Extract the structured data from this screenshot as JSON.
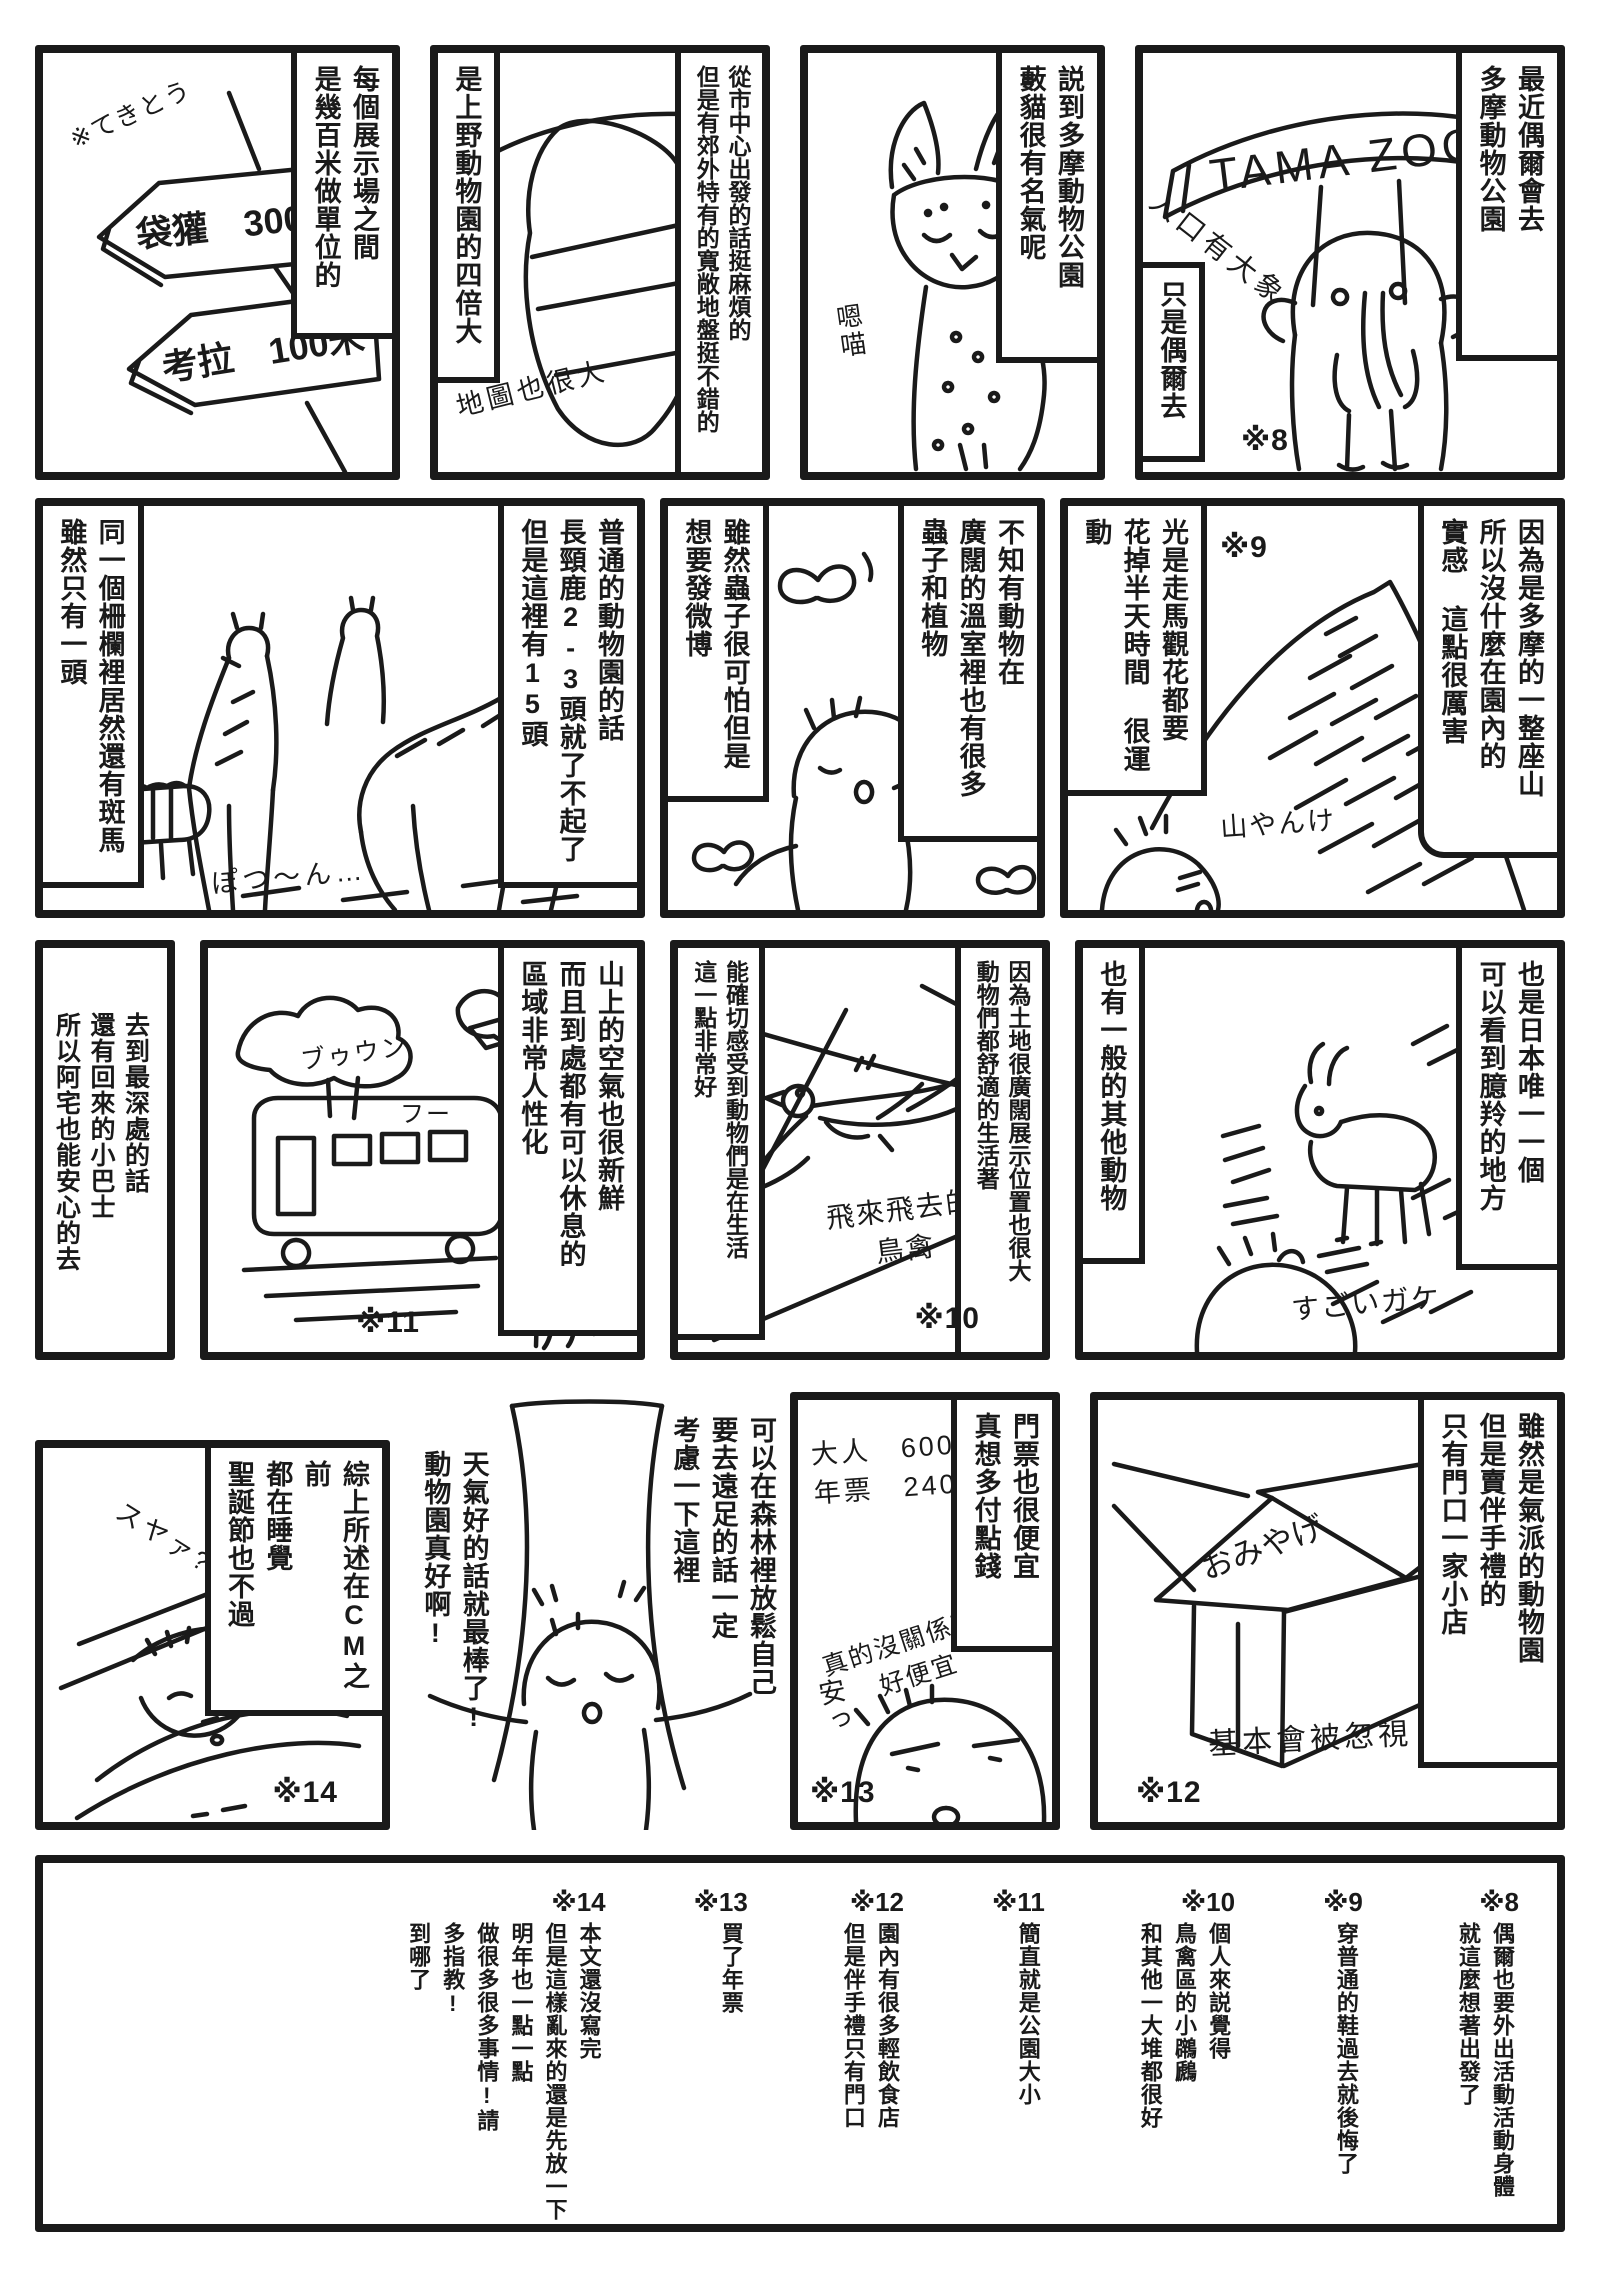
{
  "page": {
    "paper": "#ffffff",
    "ink": "#1a1a1a"
  },
  "panels": {
    "entrance": {
      "caption_right": "最近偶爾會去\n多摩動物公園",
      "caption_left": "只是偶爾去",
      "gate_sign": "TAMA ZOO",
      "note": "入口有大象",
      "marker": "※8"
    },
    "serval": {
      "caption_right": "説到多摩動物公園\n藪貓很有名氣呢",
      "note": "嗯喵"
    },
    "map": {
      "caption_right": "從市中心出發的話挺麻煩的\n但是有郊外特有的寬敞地盤挺不錯的",
      "caption_left": "是上野動物園的四倍大",
      "map_label": "MAP",
      "note": "地圖也很大"
    },
    "signpost": {
      "caption_right": "每個展示場之間\n是幾百米做單位的",
      "sign_top": "袋獾　300米",
      "sign_bottom": "考拉　100米",
      "note": "※てきとう"
    },
    "mountain": {
      "caption_right": "因為是多摩的一整座山\n所以沒什麼在園內的\n實感 這點很厲害",
      "caption_left": "光是走馬觀花都要\n花掉半天時間 很運動",
      "note": "山やんけ",
      "marker": "※9"
    },
    "greenhouse": {
      "caption_right": "不知有動物在\n廣闊的溫室裡也有很多\n蟲子和植物",
      "caption_left": "雖然蟲子很可怕但是\n想要發微博"
    },
    "giraffes": {
      "caption_right": "普通的動物園的話\n長頸鹿2-3頭就了不起了\n但是這裡有15頭",
      "caption_left": "同一個柵欄裡居然還有斑馬\n雖然只有一頭",
      "note": "ぽつ〜ん…"
    },
    "serow": {
      "caption_right": "也是日本唯一一個\n可以看到臆羚的地方",
      "caption_left": "也有一般的其他動物",
      "note": "すごいガケ"
    },
    "birds": {
      "caption_right": "因為土地很廣闊展示位置也很大\n動物們都舒適的生活著",
      "caption_left": "能確切感受到動物們是在生活\n這一點非常好",
      "note": "飛來飛去的\n鳥禽",
      "marker": "※10"
    },
    "bus": {
      "caption_right": "山上的空氣也很新鮮\n而且到處都有可以休息的\n區域非常人性化",
      "note_engine": "ブゥウン",
      "note_sigh": "フー",
      "marker": "※11"
    },
    "minibus_text": {
      "caption": "去到最深處的話\n還有回來的小巴士\n所以阿宅也能安心的去"
    },
    "shop": {
      "caption_right": "雖然是氣派的動物園\n但是賣伴手禮的\n只有門口一家小店",
      "shop_sign": "おみやげ",
      "note": "基本會被忽視",
      "marker": "※12"
    },
    "tickets": {
      "caption_right": "門票也很便宜\n真想多付點錢",
      "prices": "大人　600円\n 年票　2400円",
      "note": "真的沒關係嗎?\n好便宜",
      "note_cheap": "安っ",
      "marker": "※13"
    },
    "weather": {
      "caption_right": "可以在森林裡放鬆自己\n要去遠足的話一定\n考慮一下這裡",
      "caption_left": "天氣好的話就最棒了!\n動物園真好啊!"
    },
    "sleeping": {
      "caption_right": "綜上所述在CM之前\n都在睡覺\n聖誕節也不過",
      "note": "スヤァ?…",
      "marker": "※14"
    }
  },
  "footnotes": {
    "items": [
      {
        "marker": "※8",
        "text": "偶爾也要外出活動活動身體\n就這麼想著出發了"
      },
      {
        "marker": "※9",
        "text": "穿普通的鞋過去就後悔了"
      },
      {
        "marker": "※10",
        "text": "個人來説覺得\n鳥禽區的小鸊鷉\n和其他一大堆都很好"
      },
      {
        "marker": "※11",
        "text": "簡直就是公園大小"
      },
      {
        "marker": "※12",
        "text": "園內有很多輕飲食店\n但是伴手禮只有門口"
      },
      {
        "marker": "※13",
        "text": "買了年票"
      },
      {
        "marker": "※14",
        "text": "本文還沒寫完\n但是這樣亂來的還是先放一下\n明年也一點一點\n做很多很多事情!請\n多指教!\n到哪了"
      }
    ]
  }
}
